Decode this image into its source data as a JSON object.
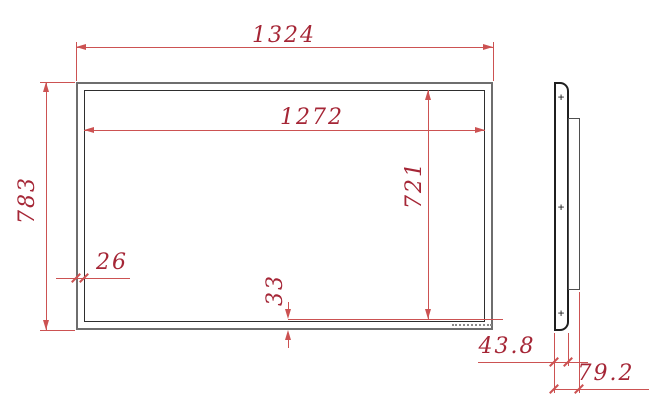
{
  "drawing_type": "technical-dimension-drawing",
  "views": {
    "front": {
      "dims": {
        "overall_width": "1324",
        "active_width": "1272",
        "overall_height": "783",
        "active_height": "721",
        "side_bezel": "26",
        "bottom_bezel": "33"
      }
    },
    "side": {
      "dims": {
        "panel_depth": "43.8",
        "total_depth": "79.2"
      },
      "center_mark": "+"
    }
  },
  "colors": {
    "dimension_line": "#cc5252",
    "dimension_text": "#a52636",
    "outer_outline": "#6e6e6e",
    "inner_outline": "#2e2e2e",
    "background": "#ffffff"
  }
}
